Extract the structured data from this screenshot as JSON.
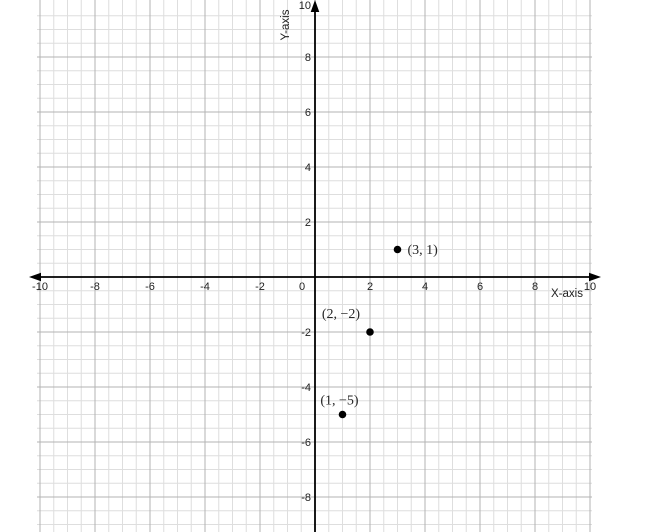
{
  "chart_data": {
    "type": "scatter",
    "title": "",
    "xlabel": "X-axis",
    "ylabel": "Y-axis",
    "xlim": [
      -10,
      10
    ],
    "ylim": [
      -9.5,
      10
    ],
    "x_tick_labels": [
      "-10",
      "-8",
      "-6",
      "-4",
      "-2",
      "0",
      "2",
      "4",
      "6",
      "8",
      "10"
    ],
    "y_tick_labels": [
      "10",
      "8",
      "6",
      "4",
      "2",
      "-2",
      "-4",
      "-6",
      "-8"
    ],
    "grid": "on",
    "minor_grid_step": 0.5,
    "major_grid_step": 2,
    "legend": "none",
    "points": [
      {
        "x": 3,
        "y": 1,
        "label": "(3, 1)",
        "label_pos": "right"
      },
      {
        "x": 2,
        "y": -2,
        "label": "(2, −2)",
        "label_pos": "above-left"
      },
      {
        "x": 1,
        "y": -5,
        "label": "(1, −5)",
        "label_pos": "above"
      }
    ]
  },
  "colors": {
    "background": "#ffffff",
    "minor_grid": "#dedede",
    "major_grid": "#b3b3b3",
    "axis": "#000000",
    "point": "#000000",
    "tick_label": "#1f1f1f",
    "point_label": "#262626",
    "axis_label": "#1f1f1f"
  }
}
